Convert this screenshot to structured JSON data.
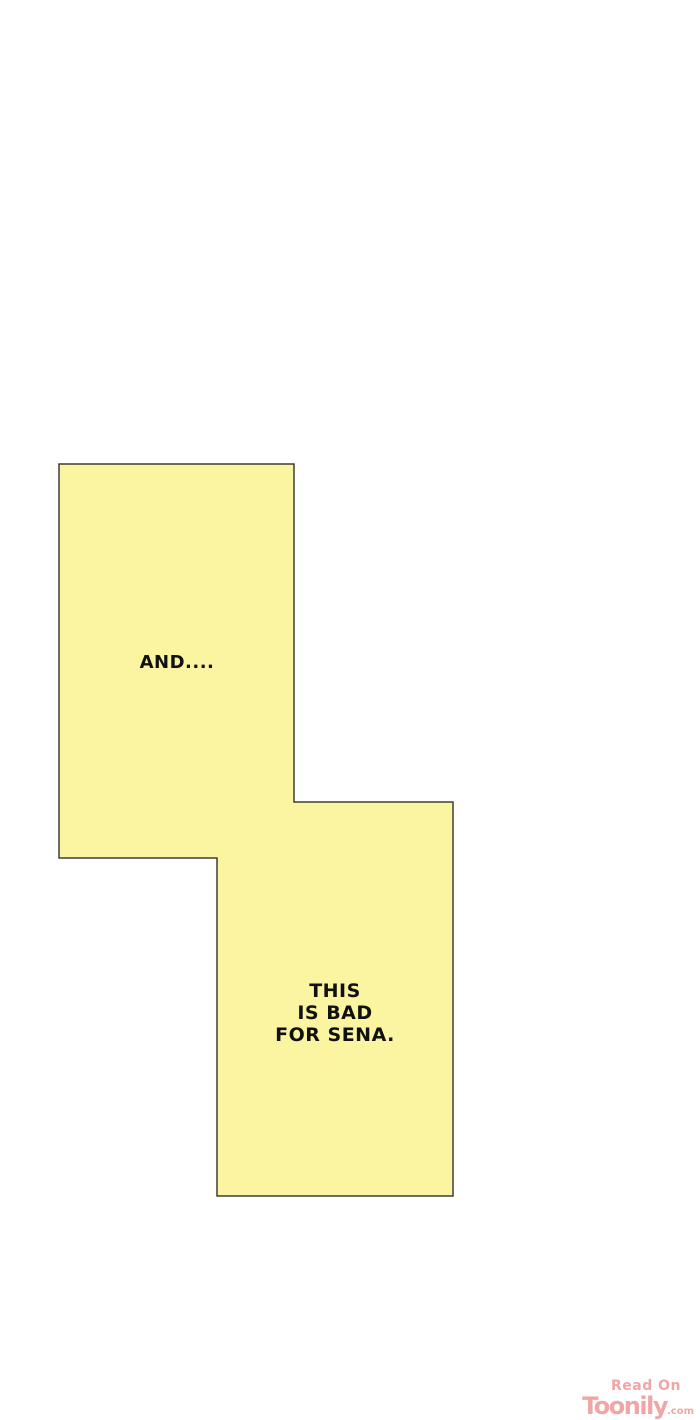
{
  "panel": {
    "fill_color": "#fbf5a1",
    "border_color": "#3e3e36",
    "text_color": "#111111",
    "bubble_and": {
      "text": "AND...."
    },
    "bubble_bad": {
      "lines": [
        "THIS",
        "IS BAD",
        "FOR SENA."
      ]
    }
  },
  "watermark": {
    "read_on": "Read On",
    "brand": "Toonily",
    "suffix": ".com",
    "color": "#f1a6a6"
  }
}
